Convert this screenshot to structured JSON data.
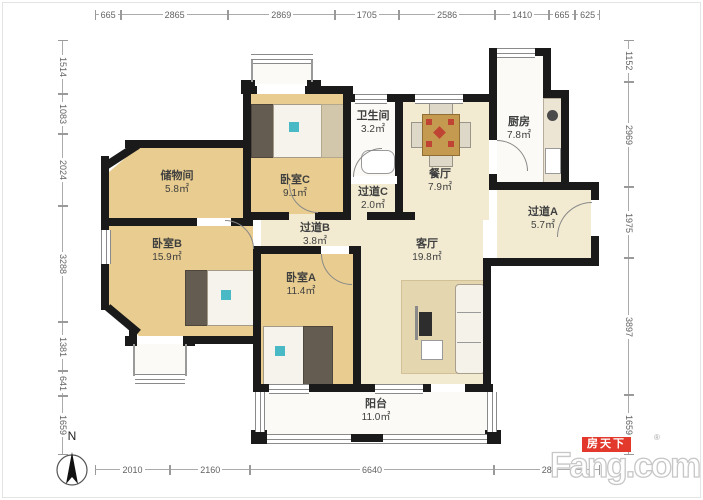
{
  "compass": {
    "label": "N"
  },
  "watermark": {
    "brand": "Fang.com",
    "brand_cn": "房天下",
    "reg_mark": "®"
  },
  "rooms": [
    {
      "name": "储物间",
      "area": "5.8㎡"
    },
    {
      "name": "卧室C",
      "area": "9.1㎡"
    },
    {
      "name": "卫生间",
      "area": "3.2㎡"
    },
    {
      "name": "过道C",
      "area": "2.0㎡"
    },
    {
      "name": "餐厅",
      "area": "7.9㎡"
    },
    {
      "name": "厨房",
      "area": "7.8㎡"
    },
    {
      "name": "过道A",
      "area": "5.7㎡"
    },
    {
      "name": "过道B",
      "area": "3.8㎡"
    },
    {
      "name": "卧室B",
      "area": "15.9㎡"
    },
    {
      "name": "卧室A",
      "area": "11.4㎡"
    },
    {
      "name": "客厅",
      "area": "19.8㎡"
    },
    {
      "name": "阳台",
      "area": "11.0㎡"
    }
  ],
  "dimensions": {
    "top": [
      "665",
      "2865",
      "2869",
      "1705",
      "2586",
      "1410",
      "665",
      "625"
    ],
    "left": [
      "1514",
      "1083",
      "2024",
      "3288",
      "1381",
      "641",
      "1659"
    ],
    "right": [
      "1152",
      "2969",
      "1975",
      "3897",
      "1659"
    ],
    "bottom": [
      "2010",
      "2160",
      "6640",
      "28"
    ]
  },
  "colors": {
    "wall": "#1a1a1a",
    "bedroom_floor": "#e9cd90",
    "living_floor": "#f2ebd2",
    "wet_area_floor": "#fbfaf6",
    "furniture_accent": "#49b9c5",
    "logo_red": "#e2392c",
    "dimension_text": "#636363"
  }
}
